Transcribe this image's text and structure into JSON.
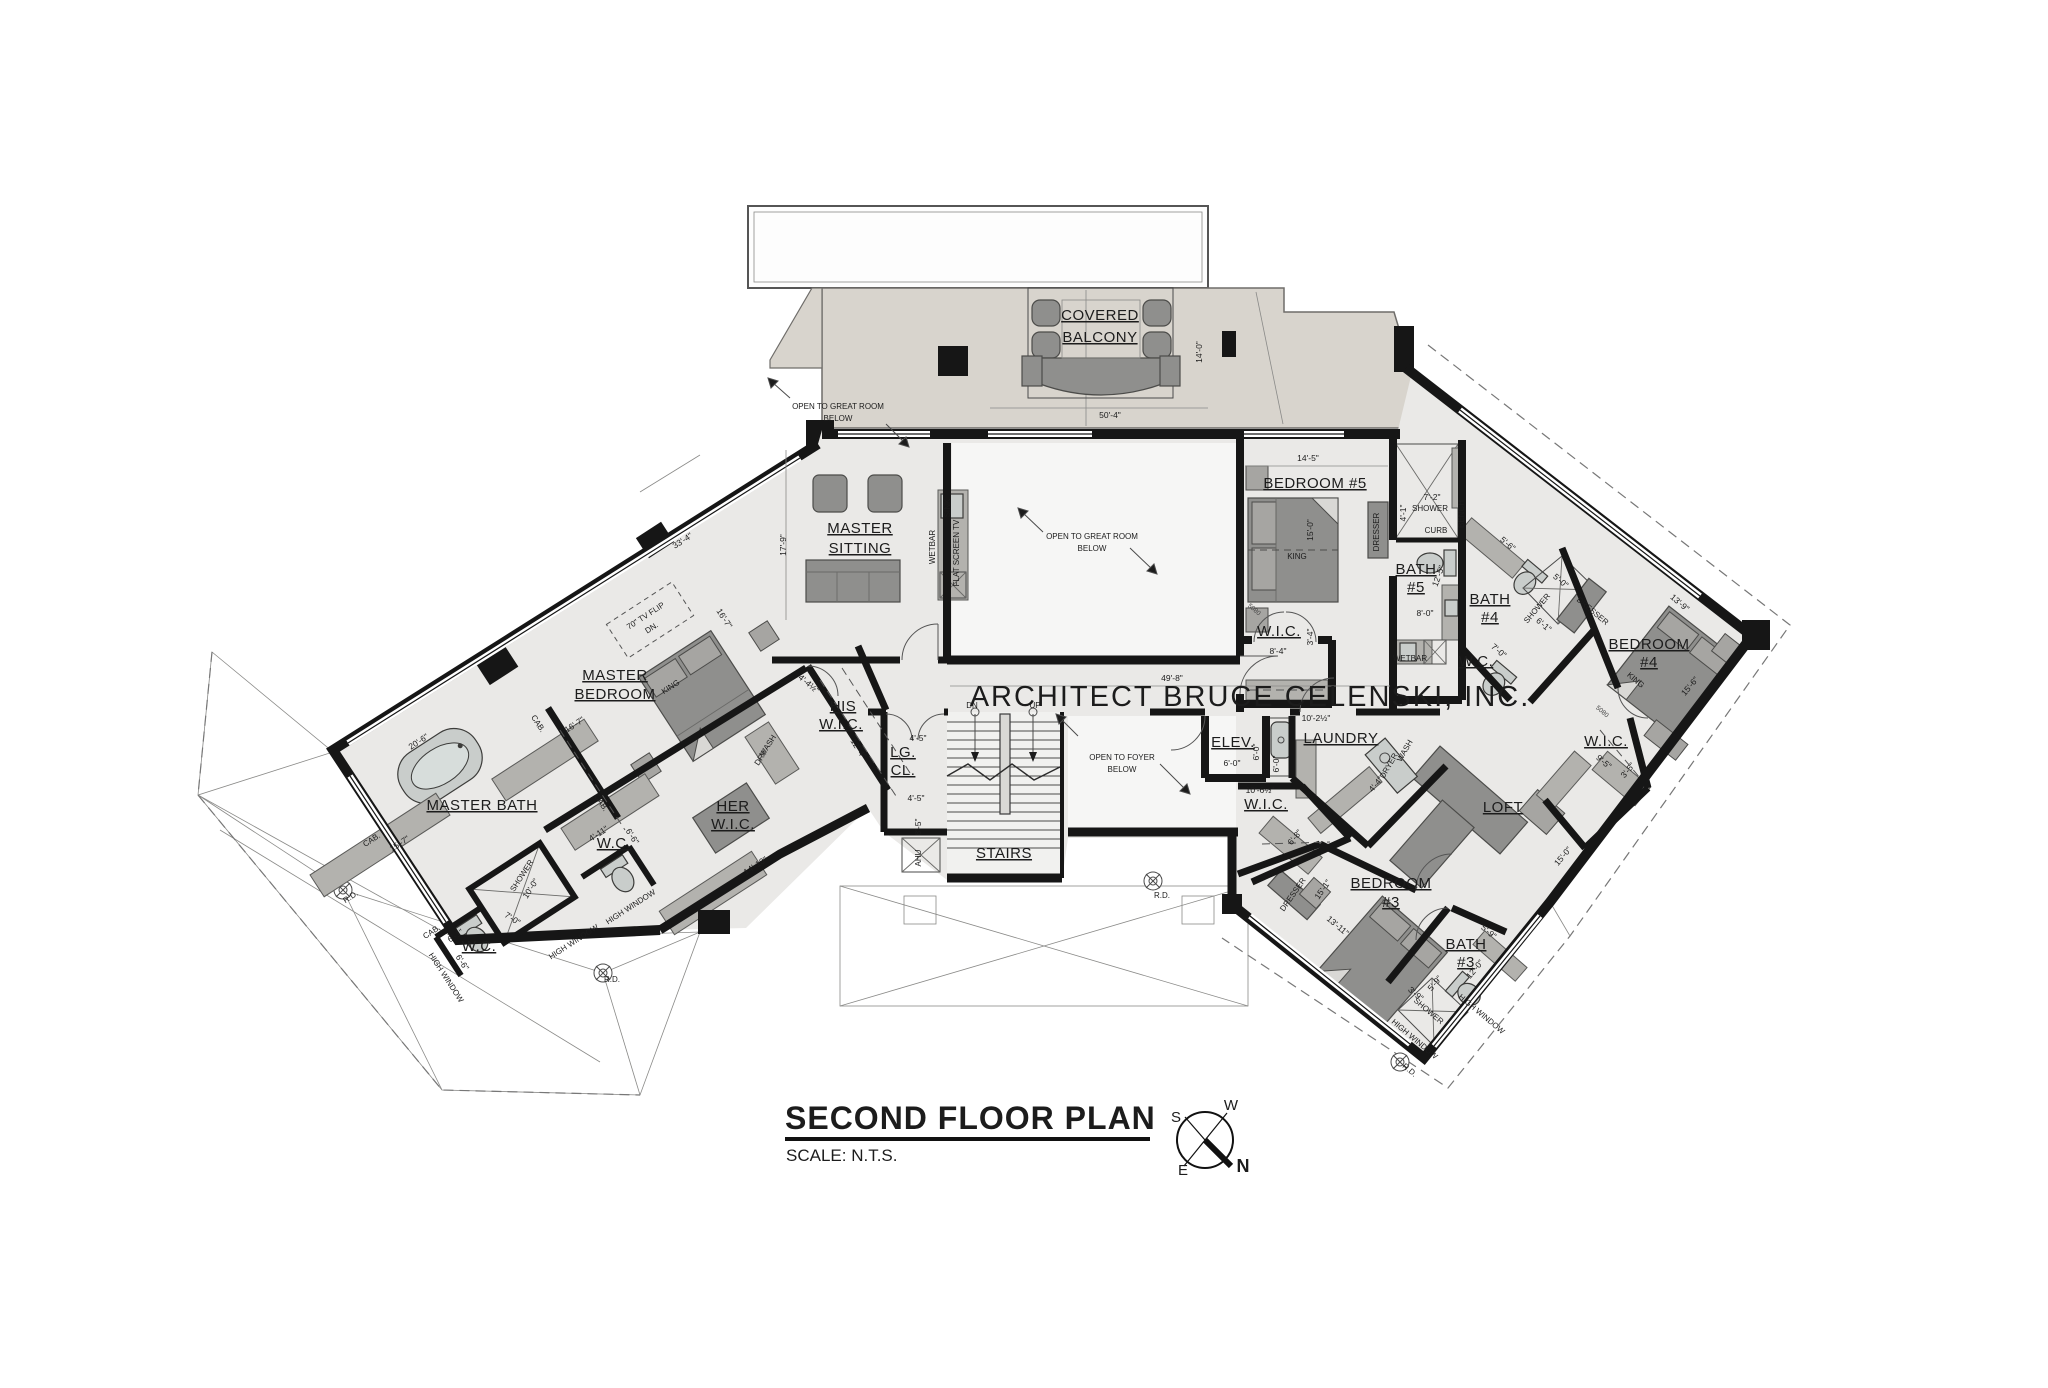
{
  "meta": {
    "width": 2048,
    "height": 1388,
    "drawing_type": "architectural floor plan"
  },
  "title_block": {
    "title": "SECOND FLOOR PLAN",
    "scale": "SCALE: N.T.S."
  },
  "architect_banner": "ARCHITECT BRUCE CELENSKI, INC.",
  "compass": {
    "n": "N",
    "s": "S",
    "e": "E",
    "w": "W"
  },
  "colors": {
    "wall": "#161616",
    "floor": "#eae9e7",
    "open_floor": "#f6f6f5",
    "deck": "#d8d4cd",
    "furniture": "#8f8f8d",
    "text": "#1c1c1c"
  },
  "plan_labels": [
    {
      "t": "COVERED",
      "x": 1100,
      "y": 320,
      "k": "room",
      "u": 1
    },
    {
      "t": "BALCONY",
      "x": 1100,
      "y": 342,
      "k": "room",
      "u": 1
    },
    {
      "t": "50'-4\"",
      "x": 1110,
      "y": 418,
      "k": "dim"
    },
    {
      "t": "14'-0\"",
      "x": 1202,
      "y": 352,
      "k": "dim",
      "r": -90
    },
    {
      "t": "14'-5\"",
      "x": 1308,
      "y": 461,
      "k": "dim"
    },
    {
      "t": "MASTER",
      "x": 860,
      "y": 533,
      "k": "room",
      "u": 1
    },
    {
      "t": "SITTING",
      "x": 860,
      "y": 553,
      "k": "room",
      "u": 1
    },
    {
      "t": "17'-9\"",
      "x": 786,
      "y": 545,
      "k": "dim",
      "r": -90
    },
    {
      "t": "33'-4\"",
      "x": 684,
      "y": 543,
      "k": "dim",
      "r": -33
    },
    {
      "t": "WETBAR",
      "x": 935,
      "y": 547,
      "k": "anno",
      "r": -90,
      "s": 7
    },
    {
      "t": "FLAT SCREEN TV",
      "x": 959,
      "y": 553,
      "k": "anno",
      "r": -90,
      "s": 7
    },
    {
      "t": "SINK",
      "x": 950,
      "y": 508,
      "k": "anno",
      "r": -90,
      "s": 6
    },
    {
      "t": "OPEN TO GREAT ROOM",
      "x": 838,
      "y": 409,
      "k": "anno"
    },
    {
      "t": "BELOW",
      "x": 838,
      "y": 421,
      "k": "anno"
    },
    {
      "t": "OPEN TO GREAT ROOM",
      "x": 1092,
      "y": 539,
      "k": "anno"
    },
    {
      "t": "BELOW",
      "x": 1092,
      "y": 551,
      "k": "anno"
    },
    {
      "t": "49'-8\"",
      "x": 1172,
      "y": 681,
      "k": "dim"
    },
    {
      "t": "DN",
      "x": 972,
      "y": 708,
      "k": "anno",
      "s": 11
    },
    {
      "t": "UP",
      "x": 1035,
      "y": 708,
      "k": "anno",
      "s": 11
    },
    {
      "t": "STAIRS",
      "x": 1004,
      "y": 858,
      "k": "room",
      "u": 1
    },
    {
      "t": "LG.",
      "x": 903,
      "y": 757,
      "k": "room",
      "u": 1,
      "s": 13
    },
    {
      "t": "CL.",
      "x": 903,
      "y": 775,
      "k": "room",
      "u": 1,
      "s": 13
    },
    {
      "t": "4'-5\"",
      "x": 918,
      "y": 741,
      "k": "dim"
    },
    {
      "t": "4'-5\"",
      "x": 916,
      "y": 801,
      "k": "dim"
    },
    {
      "t": "8'-5\"",
      "x": 921,
      "y": 827,
      "k": "dim",
      "r": -90
    },
    {
      "t": "AHU",
      "x": 921,
      "y": 858,
      "k": "anno",
      "r": -90,
      "s": 7
    },
    {
      "t": "OPEN TO FOYER",
      "x": 1122,
      "y": 760,
      "k": "anno"
    },
    {
      "t": "BELOW",
      "x": 1122,
      "y": 772,
      "k": "anno"
    },
    {
      "t": "R.D.",
      "x": 1162,
      "y": 898,
      "k": "anno",
      "s": 6
    },
    {
      "t": "BEDROOM #5",
      "x": 1315,
      "y": 488,
      "k": "room",
      "u": 1,
      "s": 16
    },
    {
      "t": "15'-0\"",
      "x": 1313,
      "y": 530,
      "k": "dim",
      "r": -90
    },
    {
      "t": "KING",
      "x": 1297,
      "y": 559,
      "k": "anno",
      "s": 7
    },
    {
      "t": "DRESSER",
      "x": 1379,
      "y": 532,
      "k": "anno",
      "r": -90,
      "s": 7
    },
    {
      "t": "W.I.C.",
      "x": 1279,
      "y": 636,
      "k": "room",
      "u": 1,
      "s": 14
    },
    {
      "t": "8'-4\"",
      "x": 1278,
      "y": 654,
      "k": "dim"
    },
    {
      "t": "3'-4\"",
      "x": 1313,
      "y": 637,
      "k": "dim",
      "r": -90
    },
    {
      "t": "5080",
      "x": 1253,
      "y": 611,
      "k": "door",
      "r": 40
    },
    {
      "t": "BATH",
      "x": 1416,
      "y": 574,
      "k": "room",
      "u": 1,
      "s": 14
    },
    {
      "t": "#5",
      "x": 1416,
      "y": 592,
      "k": "room",
      "u": 1,
      "s": 14
    },
    {
      "t": "7'-2\"",
      "x": 1432,
      "y": 500,
      "k": "dim"
    },
    {
      "t": "SHOWER",
      "x": 1430,
      "y": 511,
      "k": "anno",
      "s": 6
    },
    {
      "t": "4'-1\"",
      "x": 1406,
      "y": 513,
      "k": "dim",
      "r": -90
    },
    {
      "t": "CURB",
      "x": 1436,
      "y": 533,
      "k": "anno",
      "s": 6
    },
    {
      "t": "BENCH",
      "x": 1464,
      "y": 514,
      "k": "anno",
      "r": -90,
      "s": 6
    },
    {
      "t": "12'-5\"",
      "x": 1441,
      "y": 577,
      "k": "dim",
      "r": -70
    },
    {
      "t": "8'-0\"",
      "x": 1425,
      "y": 616,
      "k": "dim"
    },
    {
      "t": "WETBAR",
      "x": 1410,
      "y": 661,
      "k": "anno",
      "s": 6
    },
    {
      "t": "W.C.",
      "x": 1476,
      "y": 666,
      "k": "room",
      "u": 1,
      "s": 13
    },
    {
      "t": "7'-0\"",
      "x": 1497,
      "y": 653,
      "k": "dim",
      "r": 40
    },
    {
      "t": "BATH",
      "x": 1490,
      "y": 604,
      "k": "room",
      "u": 1,
      "s": 14
    },
    {
      "t": "#4",
      "x": 1490,
      "y": 622,
      "k": "room",
      "u": 1,
      "s": 14
    },
    {
      "t": "5'-6\"",
      "x": 1506,
      "y": 546,
      "k": "dim",
      "r": 40
    },
    {
      "t": "SHOWER",
      "x": 1539,
      "y": 610,
      "k": "anno",
      "s": 6,
      "r": -50
    },
    {
      "t": "5'-0\"",
      "x": 1559,
      "y": 583,
      "k": "dim",
      "r": 40
    },
    {
      "t": "6'-1\"",
      "x": 1542,
      "y": 627,
      "k": "dim",
      "r": 40
    },
    {
      "t": "BEDROOM",
      "x": 1649,
      "y": 649,
      "k": "room",
      "u": 1
    },
    {
      "t": "#4",
      "x": 1649,
      "y": 667,
      "k": "room",
      "u": 1
    },
    {
      "t": "KING",
      "x": 1634,
      "y": 682,
      "k": "anno",
      "s": 7,
      "r": 40
    },
    {
      "t": "13'-9\"",
      "x": 1678,
      "y": 605,
      "k": "dim",
      "r": 40
    },
    {
      "t": "15'-6\"",
      "x": 1692,
      "y": 688,
      "k": "dim",
      "r": -50
    },
    {
      "t": "DRESSER",
      "x": 1591,
      "y": 613,
      "k": "anno",
      "s": 7,
      "r": 40
    },
    {
      "t": "W.I.C.",
      "x": 1606,
      "y": 746,
      "k": "room",
      "u": 1,
      "s": 14
    },
    {
      "t": "9'-5\"",
      "x": 1602,
      "y": 764,
      "k": "dim",
      "r": 40
    },
    {
      "t": "3'-5\"",
      "x": 1630,
      "y": 772,
      "k": "dim",
      "r": -50
    },
    {
      "t": "5080",
      "x": 1601,
      "y": 713,
      "k": "door",
      "r": 40
    },
    {
      "t": "LOFT",
      "x": 1503,
      "y": 812,
      "k": "room",
      "u": 1
    },
    {
      "t": "15'-0\"",
      "x": 1565,
      "y": 858,
      "k": "dim",
      "r": -50
    },
    {
      "t": "LAUNDRY",
      "x": 1341,
      "y": 743,
      "k": "room",
      "u": 1,
      "s": 14
    },
    {
      "t": "10'-2½\"",
      "x": 1316,
      "y": 721,
      "k": "dim"
    },
    {
      "t": "WASH",
      "x": 1407,
      "y": 752,
      "k": "anno",
      "s": 6,
      "r": -60
    },
    {
      "t": "DRYER",
      "x": 1391,
      "y": 767,
      "k": "anno",
      "s": 6,
      "r": -60
    },
    {
      "t": "6'-0\"",
      "x": 1279,
      "y": 764,
      "k": "dim",
      "r": -90
    },
    {
      "t": "4'-4\"",
      "x": 1378,
      "y": 786,
      "k": "dim",
      "r": -50
    },
    {
      "t": "ELEV.",
      "x": 1233,
      "y": 747,
      "k": "room",
      "u": 1,
      "s": 13
    },
    {
      "t": "6'-0\"",
      "x": 1232,
      "y": 766,
      "k": "dim"
    },
    {
      "t": "6'-0\"",
      "x": 1259,
      "y": 752,
      "k": "dim",
      "r": -90
    },
    {
      "t": "10'-6½\"",
      "x": 1260,
      "y": 793,
      "k": "dim"
    },
    {
      "t": "W.I.C.",
      "x": 1266,
      "y": 809,
      "k": "room",
      "u": 1,
      "s": 14
    },
    {
      "t": "6'-8\"",
      "x": 1297,
      "y": 839,
      "k": "dim",
      "r": -50
    },
    {
      "t": "BEDROOM",
      "x": 1391,
      "y": 888,
      "k": "room",
      "u": 1
    },
    {
      "t": "#3",
      "x": 1391,
      "y": 907,
      "k": "room",
      "u": 1
    },
    {
      "t": "15'-1\"",
      "x": 1325,
      "y": 891,
      "k": "dim",
      "r": -55
    },
    {
      "t": "13'-11\"",
      "x": 1336,
      "y": 928,
      "k": "dim",
      "r": 40
    },
    {
      "t": "DRESSER",
      "x": 1295,
      "y": 896,
      "k": "anno",
      "s": 7,
      "r": -55
    },
    {
      "t": "BATH",
      "x": 1466,
      "y": 949,
      "k": "room",
      "u": 1,
      "s": 14
    },
    {
      "t": "#3",
      "x": 1466,
      "y": 967,
      "k": "room",
      "u": 1,
      "s": 14
    },
    {
      "t": "5'-9\"",
      "x": 1487,
      "y": 934,
      "k": "dim",
      "r": 40
    },
    {
      "t": "12'-0\"",
      "x": 1477,
      "y": 971,
      "k": "dim",
      "r": -50
    },
    {
      "t": "SHOWER",
      "x": 1427,
      "y": 1013,
      "k": "anno",
      "s": 6,
      "r": 40
    },
    {
      "t": "3'-9\"",
      "x": 1414,
      "y": 996,
      "k": "dim",
      "r": 40
    },
    {
      "t": "5'-9\"",
      "x": 1437,
      "y": 985,
      "k": "dim",
      "r": -50
    },
    {
      "t": "HIGH WINDOW",
      "x": 1413,
      "y": 1041,
      "k": "anno",
      "s": 6,
      "r": 40
    },
    {
      "t": "HIGH WINDOW",
      "x": 1480,
      "y": 1016,
      "k": "anno",
      "s": 6,
      "r": 40
    },
    {
      "t": "R.D.",
      "x": 1408,
      "y": 1072,
      "k": "anno",
      "s": 6,
      "r": 40
    },
    {
      "t": "MASTER",
      "x": 615,
      "y": 680,
      "k": "room",
      "u": 1
    },
    {
      "t": "BEDROOM",
      "x": 615,
      "y": 699,
      "k": "room",
      "u": 1
    },
    {
      "t": "70\" TV FLIP",
      "x": 647,
      "y": 618,
      "k": "anno",
      "s": 7,
      "r": -33
    },
    {
      "t": "DN.",
      "x": 653,
      "y": 630,
      "k": "anno",
      "s": 7,
      "r": -33
    },
    {
      "t": "16'-7\"",
      "x": 576,
      "y": 727,
      "k": "dim",
      "r": -33
    },
    {
      "t": "16'-7\"",
      "x": 722,
      "y": 620,
      "k": "dim",
      "r": 57
    },
    {
      "t": "KING",
      "x": 672,
      "y": 689,
      "k": "anno",
      "s": 7,
      "r": -33
    },
    {
      "t": "HIS",
      "x": 843,
      "y": 711,
      "k": "room",
      "u": 1,
      "s": 14
    },
    {
      "t": "W.I.C.",
      "x": 841,
      "y": 729,
      "k": "room",
      "u": 1,
      "s": 14
    },
    {
      "t": "12'-4\"",
      "x": 856,
      "y": 750,
      "k": "dim",
      "r": 57
    },
    {
      "t": "4'-4½\"",
      "x": 807,
      "y": 686,
      "k": "dim",
      "r": 40
    },
    {
      "t": "HER",
      "x": 733,
      "y": 811,
      "k": "room",
      "u": 1,
      "s": 14
    },
    {
      "t": "W.I.C.",
      "x": 733,
      "y": 829,
      "k": "room",
      "u": 1,
      "s": 14
    },
    {
      "t": "WASH",
      "x": 770,
      "y": 747,
      "k": "anno",
      "s": 6,
      "r": -57
    },
    {
      "t": "DRY",
      "x": 763,
      "y": 759,
      "k": "anno",
      "s": 6,
      "r": -57
    },
    {
      "t": "MASTER BATH",
      "x": 482,
      "y": 810,
      "k": "room",
      "u": 1
    },
    {
      "t": "20'-6\"",
      "x": 420,
      "y": 744,
      "k": "dim",
      "r": -33
    },
    {
      "t": "15'-7\"",
      "x": 401,
      "y": 846,
      "k": "dim",
      "r": -33
    },
    {
      "t": "CAB.",
      "x": 536,
      "y": 725,
      "k": "anno",
      "s": 6,
      "r": 57
    },
    {
      "t": "CAB.",
      "x": 599,
      "y": 804,
      "k": "anno",
      "s": 6,
      "r": 57
    },
    {
      "t": "CAB.",
      "x": 373,
      "y": 842,
      "k": "anno",
      "s": 6,
      "r": -33
    },
    {
      "t": "CAB.",
      "x": 433,
      "y": 934,
      "k": "anno",
      "s": 6,
      "r": -33
    },
    {
      "t": "SHOWER",
      "x": 524,
      "y": 877,
      "k": "anno",
      "s": 6,
      "r": -57
    },
    {
      "t": "10'-0\"",
      "x": 533,
      "y": 890,
      "k": "dim",
      "r": -57
    },
    {
      "t": "7'-0\"",
      "x": 511,
      "y": 921,
      "k": "dim",
      "r": 33
    },
    {
      "t": "W.C.",
      "x": 479,
      "y": 951,
      "k": "room",
      "u": 1,
      "s": 13
    },
    {
      "t": "6'-1\"",
      "x": 457,
      "y": 938,
      "k": "dim",
      "r": -33
    },
    {
      "t": "6'-6\"",
      "x": 460,
      "y": 964,
      "k": "dim",
      "r": 57
    },
    {
      "t": "W.C.",
      "x": 614,
      "y": 848,
      "k": "room",
      "u": 1,
      "s": 13
    },
    {
      "t": "4'-11\"",
      "x": 600,
      "y": 836,
      "k": "dim",
      "r": -33
    },
    {
      "t": "6'-6\"",
      "x": 630,
      "y": 838,
      "k": "dim",
      "r": 57
    },
    {
      "t": "HIGH WINDOW",
      "x": 575,
      "y": 944,
      "k": "anno",
      "s": 6,
      "r": -33
    },
    {
      "t": "HIGH WINDOW",
      "x": 632,
      "y": 909,
      "k": "anno",
      "s": 6,
      "r": -33
    },
    {
      "t": "HIGH WINDOW",
      "x": 444,
      "y": 979,
      "k": "anno",
      "s": 6,
      "r": 57
    },
    {
      "t": "R.D.",
      "x": 352,
      "y": 899,
      "k": "anno",
      "s": 6,
      "r": -33
    },
    {
      "t": "R.D.",
      "x": 612,
      "y": 982,
      "k": "anno",
      "s": 6
    },
    {
      "t": "14'-10\"",
      "x": 757,
      "y": 868,
      "k": "dim",
      "r": -33
    }
  ]
}
